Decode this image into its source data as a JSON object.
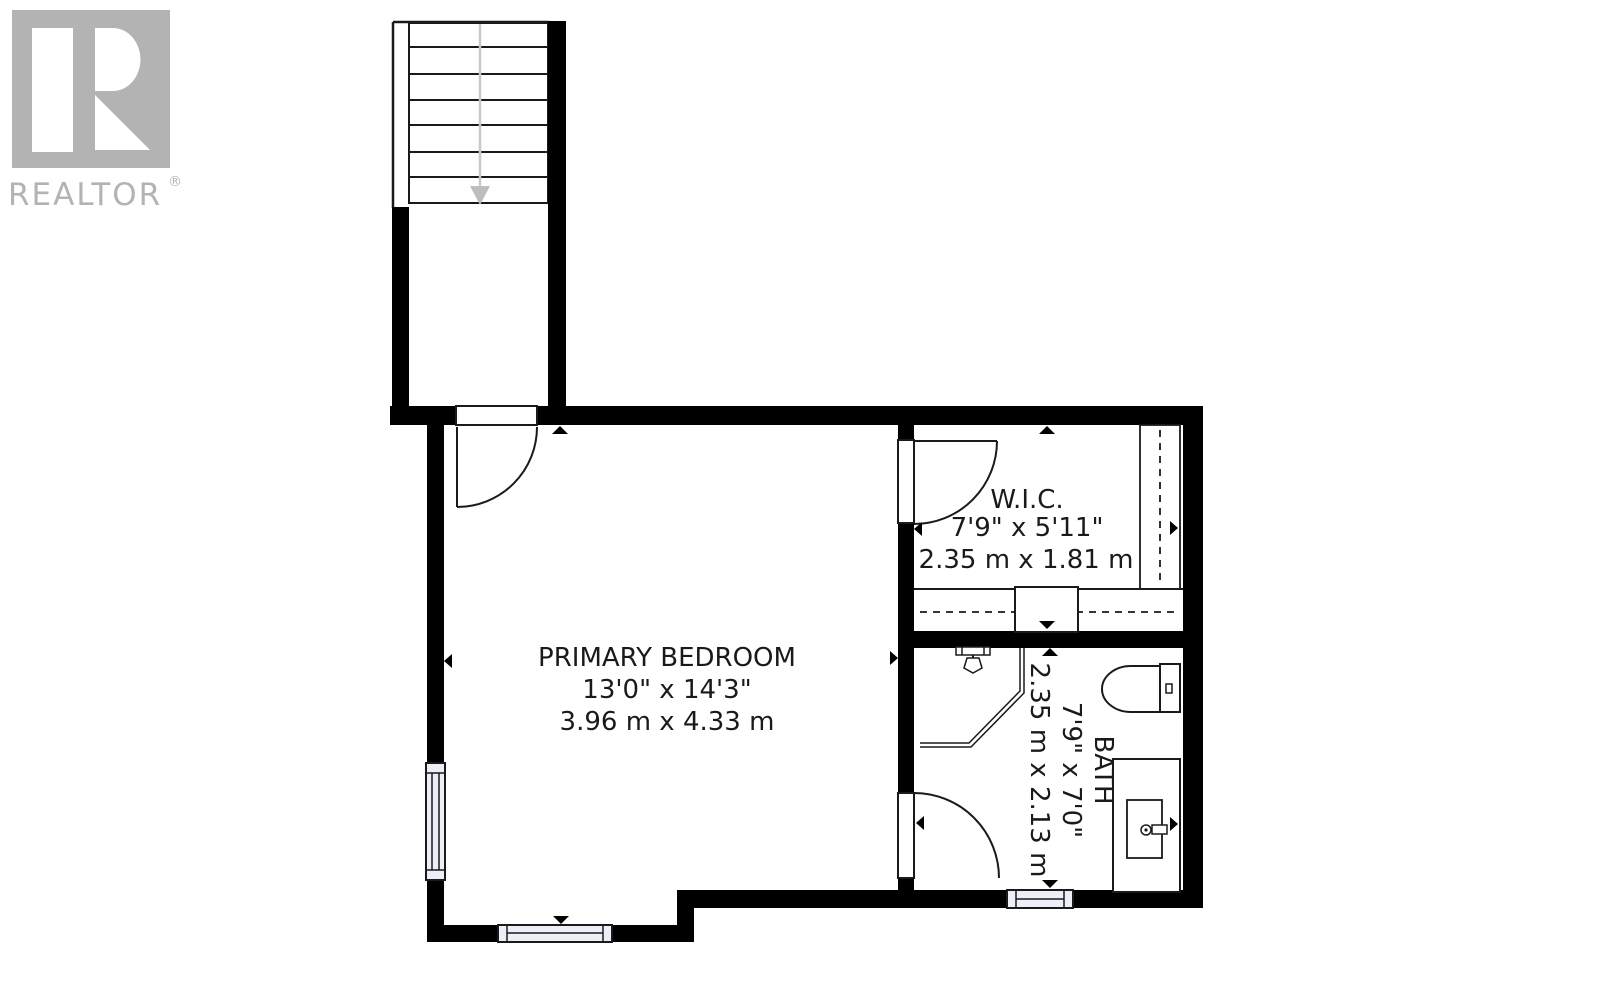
{
  "branding": {
    "logo_text": "REALTOR",
    "registered_mark": "®"
  },
  "floorplan": {
    "rooms": [
      {
        "name": "PRIMARY BEDROOM",
        "imperial": "13'0\" x 14'3\"",
        "metric": "3.96 m x 4.33 m"
      },
      {
        "name": "W.I.C.",
        "imperial": "7'9\" x 5'11\"",
        "metric": "2.35 m x 1.81 m"
      },
      {
        "name": "BATH",
        "imperial": "7'9\" x 7'0\"",
        "metric": "2.35 m x 2.13 m"
      }
    ],
    "features": [
      "staircase-down",
      "windows",
      "doors",
      "closet",
      "shower",
      "toilet",
      "vanity-sink"
    ],
    "colors": {
      "wall": "#000000",
      "thin_line": "#1a1a1a",
      "window_fill": "#edeff8",
      "stair_arrow": "#bdbdbd",
      "logo_gray": "#b3b3b3",
      "background": "#ffffff",
      "text": "#1a1a1a"
    }
  }
}
